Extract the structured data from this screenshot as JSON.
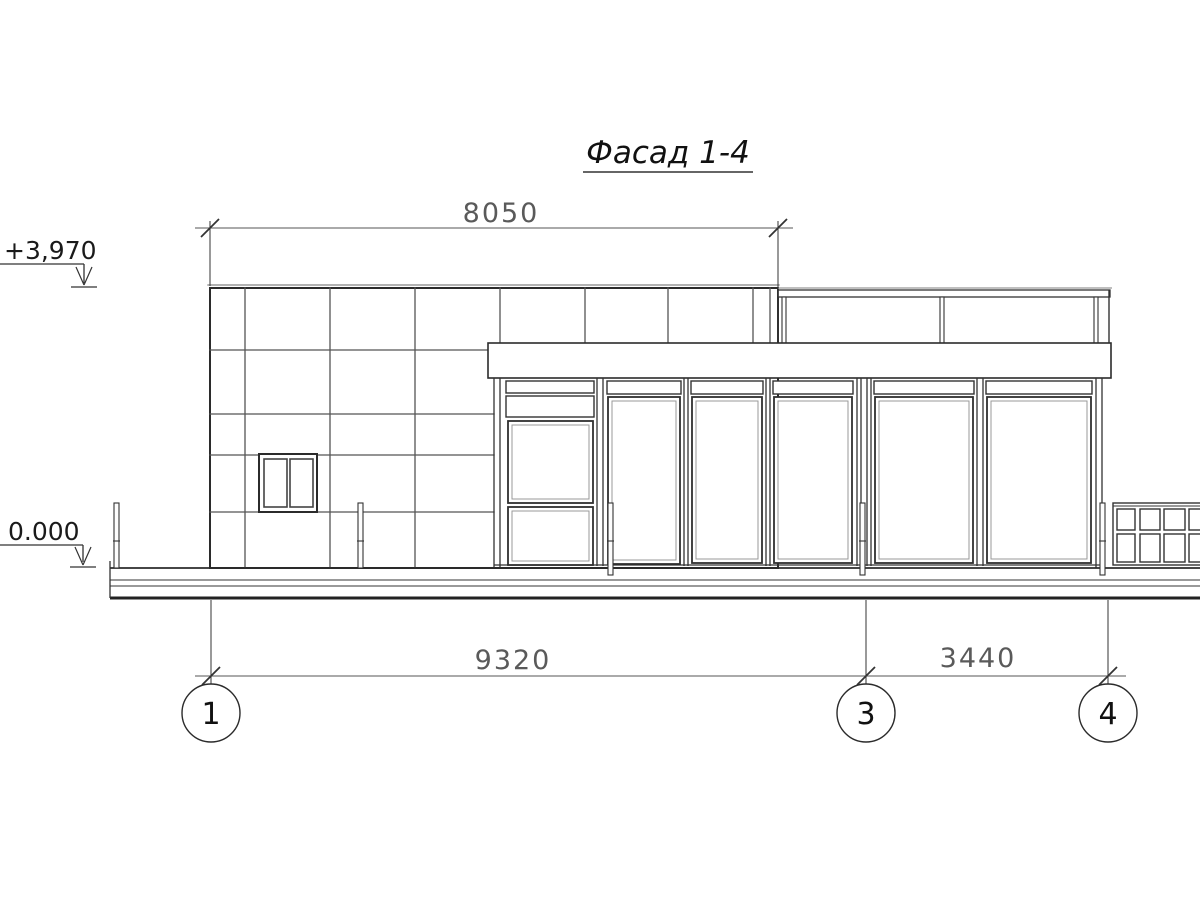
{
  "drawing": {
    "type": "architectural-elevation",
    "title": {
      "text": "Фасад 1-4"
    },
    "levels": {
      "top": {
        "label": "+3,970"
      },
      "ground": {
        "label": "0.000"
      }
    },
    "dimensions": {
      "top_width": {
        "label": "8050"
      },
      "bottom_left_span": {
        "label": "9320"
      },
      "bottom_right_span": {
        "label": "3440"
      }
    },
    "axes": [
      {
        "label": "1"
      },
      {
        "label": "3"
      },
      {
        "label": "4"
      }
    ],
    "colors": {
      "paper": "#ffffff",
      "ink_heavy": "#2b2b2b",
      "ink_medium": "#555555",
      "ink_dim_line": "#777777",
      "ink_light": "#999999"
    }
  }
}
